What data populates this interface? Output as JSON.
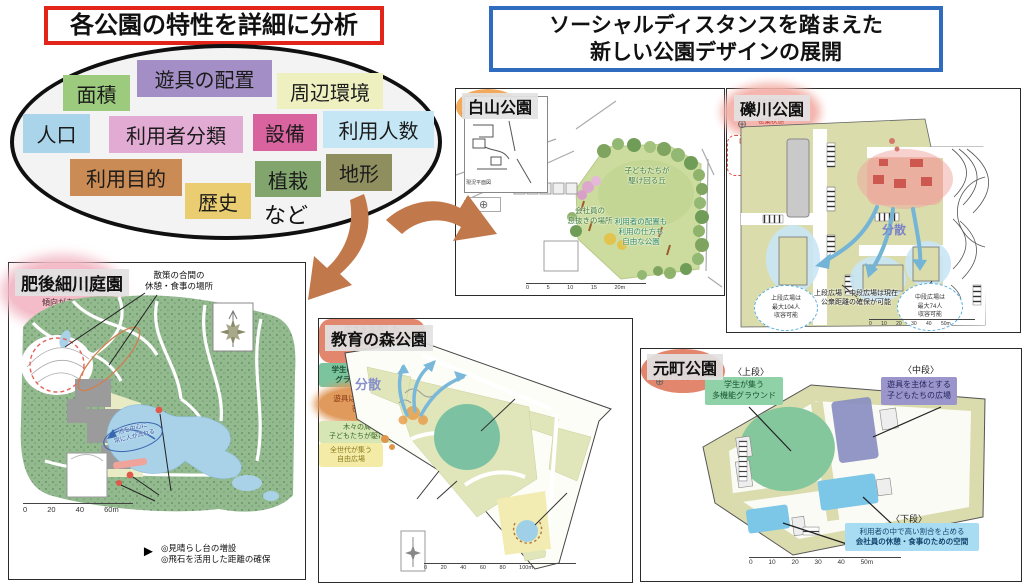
{
  "header": {
    "analysis_title": "各公園の特性を詳細に分析",
    "design_title": "ソーシャルディスタンスを踏まえた\n新しい公園デザインの展開"
  },
  "colors": {
    "analysis_border": "#e1251b",
    "design_border": "#2f6bbf",
    "flow_arrow": "#c1784a"
  },
  "icons": {
    "compass_star": "✳",
    "compass_small": "⊕",
    "pointer_arrow": "►"
  },
  "analysis_tags": [
    {
      "label": "面積",
      "bg": "#9ccb7d"
    },
    {
      "label": "遊具の配置",
      "bg": "#a38fc5"
    },
    {
      "label": "周辺環境",
      "bg": "#eef0c0"
    },
    {
      "label": "人口",
      "bg": "#a9d4ea"
    },
    {
      "label": "利用者分類",
      "bg": "#e2abd4"
    },
    {
      "label": "設備",
      "bg": "#d9639f"
    },
    {
      "label": "利用人数",
      "bg": "#c4e6f5"
    },
    {
      "label": "利用目的",
      "bg": "#cb8b55"
    },
    {
      "label": "歴史",
      "bg": "#e9cd70"
    },
    {
      "label": "植栽",
      "bg": "#82a56d"
    },
    {
      "label": "地形",
      "bg": "#8e8e5e"
    }
  ],
  "analysis_etc": "など",
  "parks": {
    "hakusan": {
      "name": "白山公園",
      "inset_caption": "現況平面図",
      "hill": "子どもたちが\n駆け回る丘",
      "workers": "会社員の\n息抜きの場所",
      "free_use": "利用者の配置も\n利用の仕方も\n自由な公園",
      "bubble": "遊具をなくし\n広場主体の\n多世代が集う公園に",
      "scale": "0 5 10 15 20m"
    },
    "rekisen": {
      "name": "礫川公園",
      "crowd": "遊具周辺は\n子どもたちが集まり\n密集状態",
      "capacity_title": "【適正利用人数】",
      "capacity_items": "砂場:3人\n滑り台:10人\nブランコ:8人",
      "dispersal": "分散",
      "upper_capacity": "上段広場は\n最大104人\n収容可能",
      "middle_capacity": "中段広場は\n最大74人\n収容可能",
      "note": "上段広場・中段広場は現在\n公衆距離の確保が可能",
      "scale": "0 10 20 30 40 50m"
    },
    "higo": {
      "name": "肥後細川庭園",
      "rest_spot": "散策の合間の\n休憩・食事の場所",
      "pond_flow": "池を中心に\n常に人が流れる",
      "scenic": "絶景ポイントには\n利用者が集中する\n傾向がある",
      "bullets": "◎見晴らし台の増設\n◎飛石を活用した距離の確保",
      "scale": "0 20 40 60m"
    },
    "kyoiku": {
      "name": "教育の森公園",
      "multi_use": "広さを活用した\n世代を超えて愛される\n多機能公園",
      "ground": "学生のための\nグラウンド",
      "dispersal": "分散",
      "crowded": "遊具は広場と比べて\n密集状態",
      "trees": "木々の周りを\n子どもたちが駆け回る",
      "plaza": "全世代が集う\n自由広場",
      "scale": "0 20 40 60 80 100m"
    },
    "motomachi": {
      "name": "元町公園",
      "upper_label": "〈上段〉",
      "upper_text": "学生が集う\n多機能グラウンド",
      "middle_label": "〈中段〉",
      "middle_text": "遊具を主体とする\n子どもたちの広場",
      "lower_label": "〈下段〉",
      "lower_text_1": "利用者の中で高い割合を占める",
      "lower_text_2": "会社員の休憩・食事のための空間",
      "four_spaces": "上下に分かれた\n4つの空間の活用",
      "scale": "0 10 20 30 40 50m"
    }
  }
}
